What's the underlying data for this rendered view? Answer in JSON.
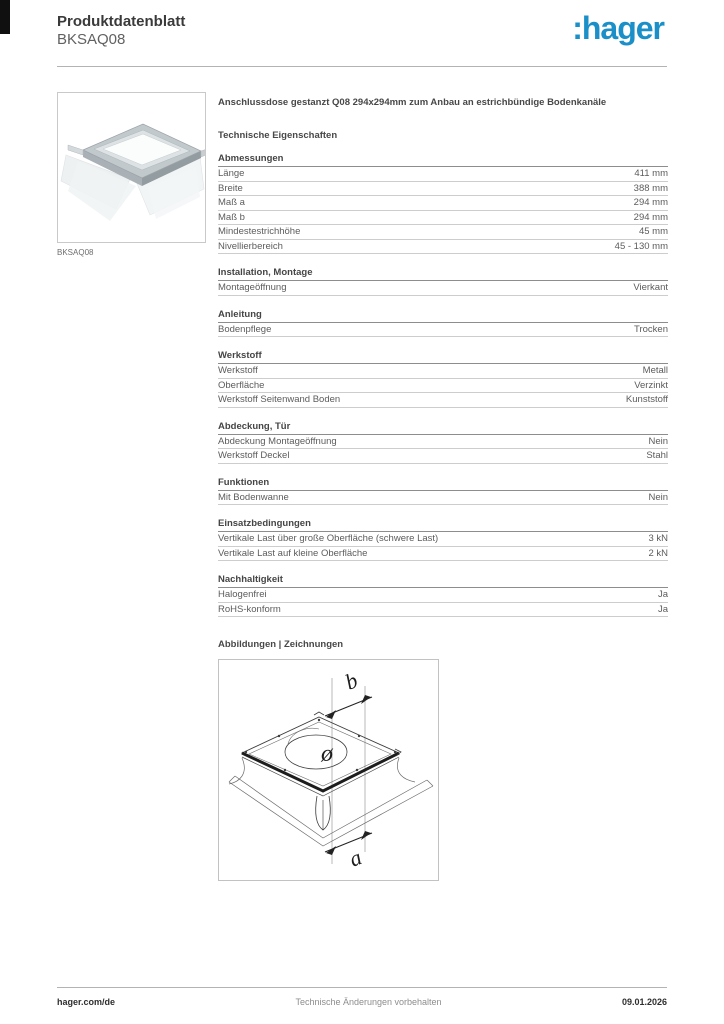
{
  "header": {
    "title": "Produktdatenblatt",
    "subtitle": "BKSAQ08",
    "logo_text": ":hager",
    "logo_color": "#1b90c8"
  },
  "product": {
    "image_caption": "BKSAQ08"
  },
  "description": "Anschlussdose gestanzt Q08 294x294mm zum Anbau an estrichbündige Bodenkanäle",
  "tech_properties_heading": "Technische Eigenschaften",
  "sections": [
    {
      "title": "Abmessungen",
      "rows": [
        {
          "label": "Länge",
          "value": "411 mm"
        },
        {
          "label": "Breite",
          "value": "388 mm"
        },
        {
          "label": "Maß a",
          "value": "294 mm"
        },
        {
          "label": "Maß b",
          "value": "294 mm"
        },
        {
          "label": "Mindestestrichhöhe",
          "value": "45 mm"
        },
        {
          "label": "Nivellierbereich",
          "value": "45 - 130 mm"
        }
      ]
    },
    {
      "title": "Installation, Montage",
      "rows": [
        {
          "label": "Montageöffnung",
          "value": "Vierkant"
        }
      ]
    },
    {
      "title": "Anleitung",
      "rows": [
        {
          "label": "Bodenpflege",
          "value": "Trocken"
        }
      ]
    },
    {
      "title": "Werkstoff",
      "rows": [
        {
          "label": "Werkstoff",
          "value": "Metall"
        },
        {
          "label": "Oberfläche",
          "value": "Verzinkt"
        },
        {
          "label": "Werkstoff Seitenwand Boden",
          "value": "Kunststoff"
        }
      ]
    },
    {
      "title": "Abdeckung, Tür",
      "rows": [
        {
          "label": "Abdeckung Montageöffnung",
          "value": "Nein"
        },
        {
          "label": "Werkstoff Deckel",
          "value": "Stahl"
        }
      ]
    },
    {
      "title": "Funktionen",
      "rows": [
        {
          "label": "Mit Bodenwanne",
          "value": "Nein"
        }
      ]
    },
    {
      "title": "Einsatzbedingungen",
      "rows": [
        {
          "label": "Vertikale Last über große Oberfläche (schwere Last)",
          "value": "3 kN"
        },
        {
          "label": "Vertikale Last auf kleine Oberfläche",
          "value": "2 kN"
        }
      ]
    },
    {
      "title": "Nachhaltigkeit",
      "rows": [
        {
          "label": "Halogenfrei",
          "value": "Ja"
        },
        {
          "label": "RoHS-konform",
          "value": "Ja"
        }
      ]
    }
  ],
  "drawings": {
    "heading": "Abbildungen | Zeichnungen",
    "dimension_labels": {
      "width": "b",
      "diameter": "ø",
      "length": "a"
    }
  },
  "footer": {
    "left": "hager.com/de",
    "center": "Technische Änderungen vorbehalten",
    "right": "09.01.2026"
  }
}
